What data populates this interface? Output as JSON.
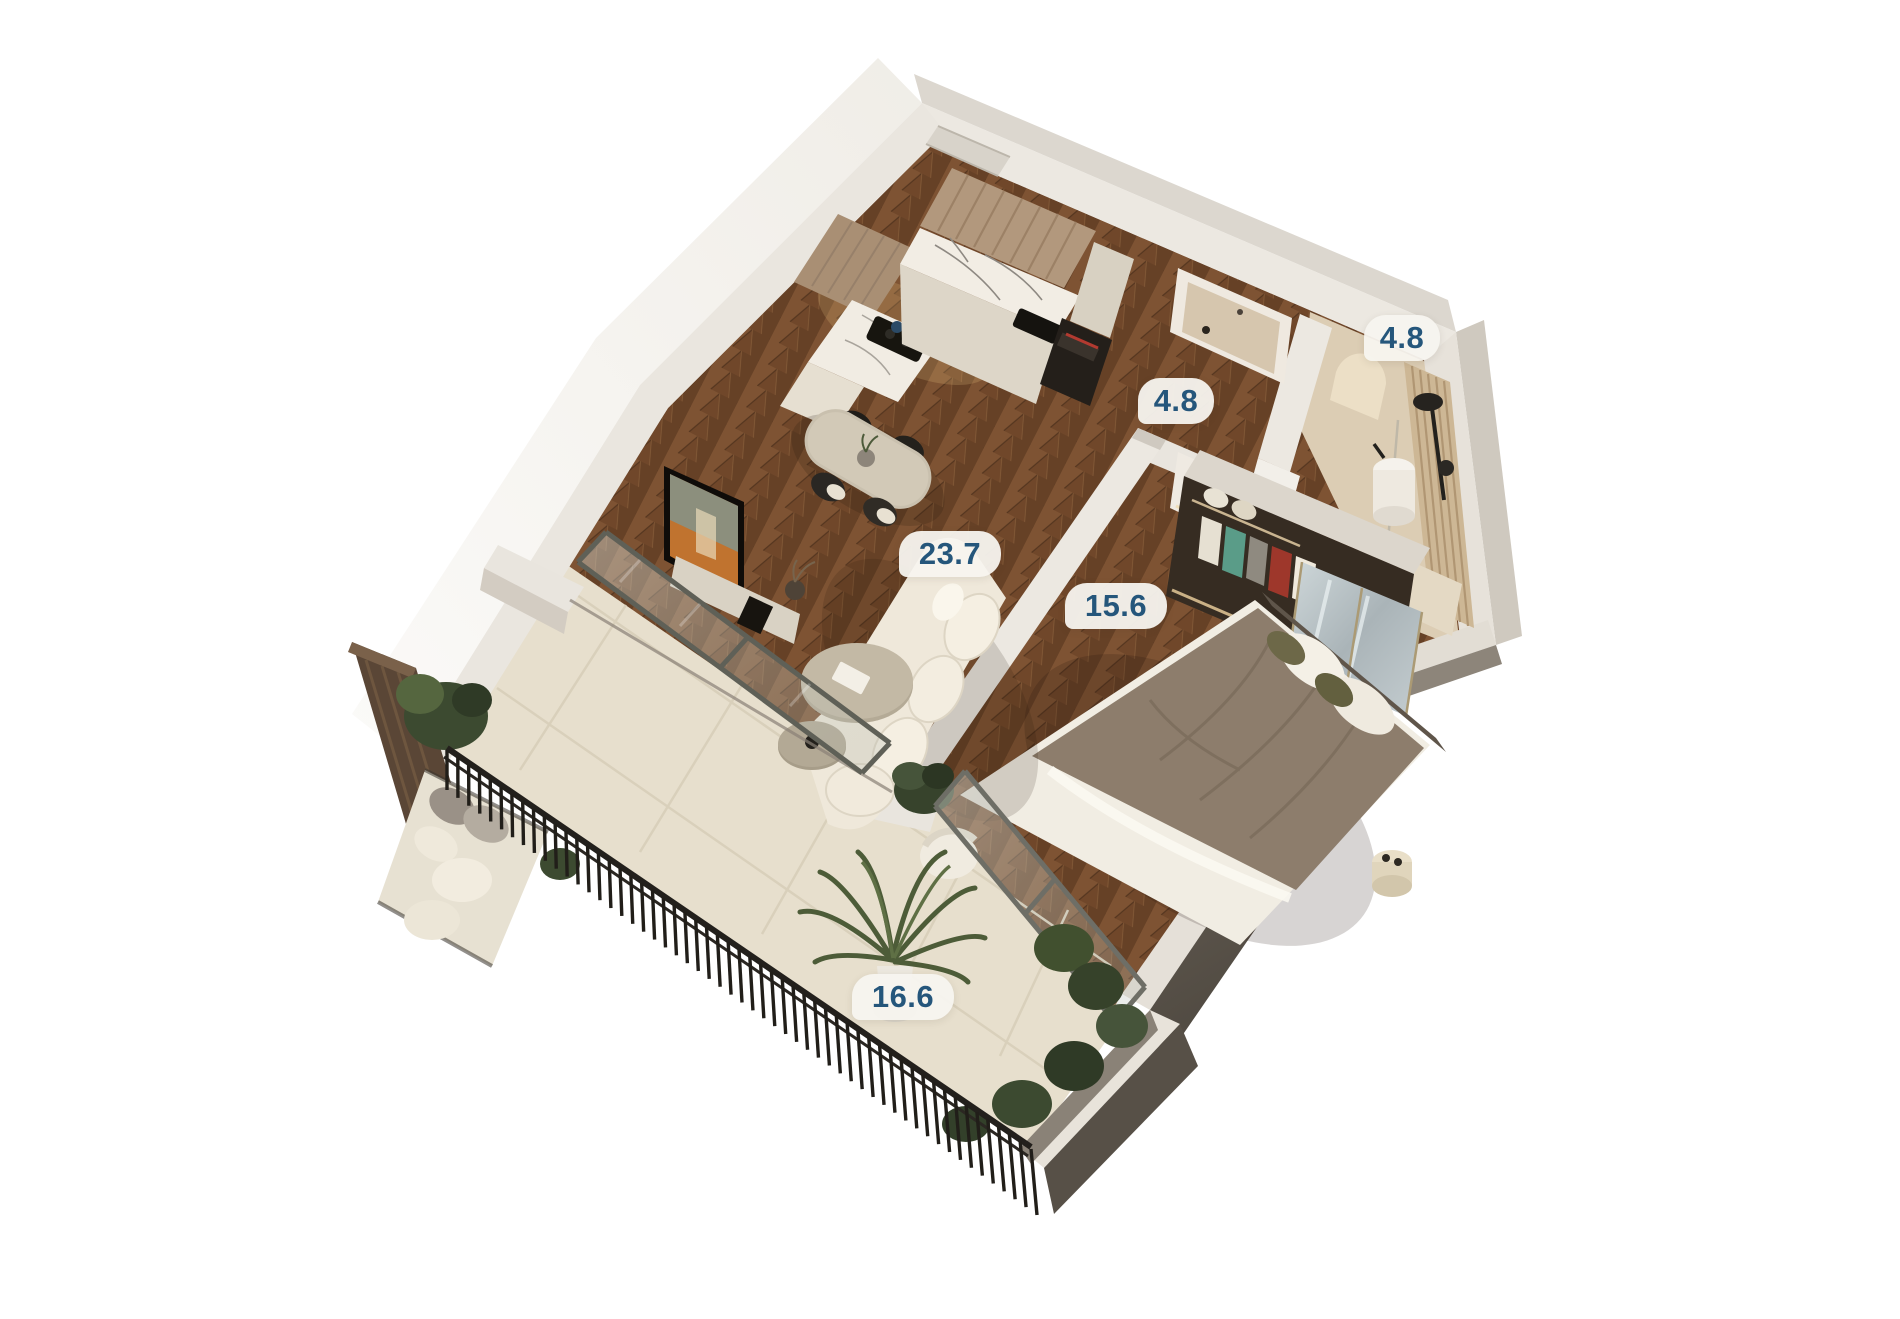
{
  "scene": {
    "description": "3D axonometric floor plan render of a one-bedroom apartment with balcony",
    "background_color": "#ffffff",
    "label_text_color": "#25567b",
    "label_pill_color": "#f7f4ef"
  },
  "rooms": [
    {
      "id": "kitchen-living-room",
      "area_label": "23.7"
    },
    {
      "id": "bedroom",
      "area_label": "15.6"
    },
    {
      "id": "hallway",
      "area_label": "4.8"
    },
    {
      "id": "bathroom",
      "area_label": "4.8"
    },
    {
      "id": "balcony",
      "area_label": "16.6"
    }
  ]
}
